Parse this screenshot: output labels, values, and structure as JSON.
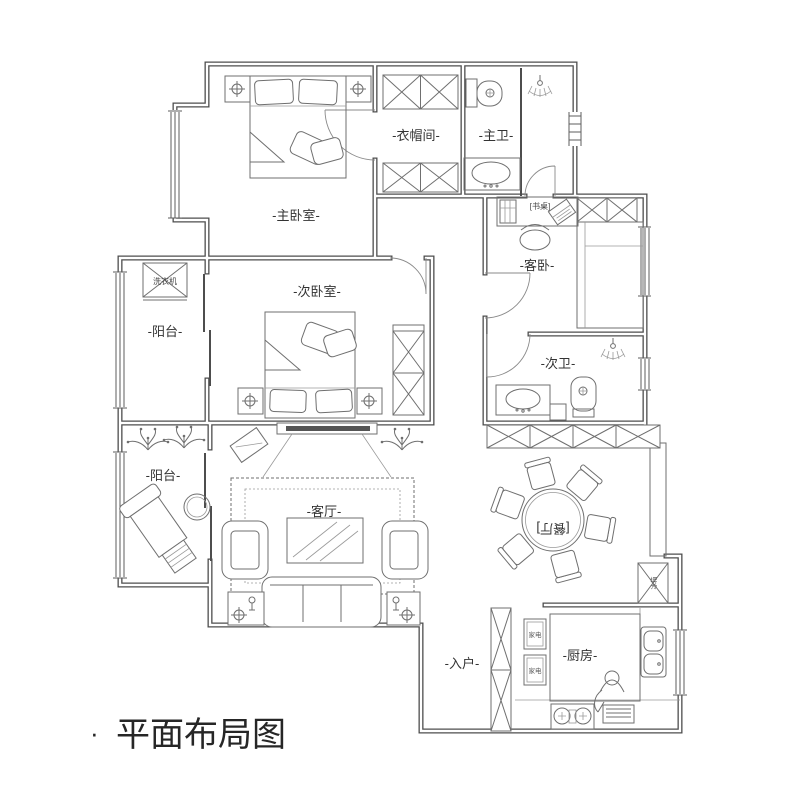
{
  "title": {
    "bullet": "·",
    "text": "平面布局图"
  },
  "rooms": {
    "master_bedroom": "-主卧室-",
    "closet": "-衣帽间-",
    "master_bath": "-主卫-",
    "second_bedroom": "-次卧室-",
    "balcony_upper": "-阳台-",
    "balcony_lower": "-阳台-",
    "guest_bedroom": "-客卧-",
    "second_bath": "-次卫-",
    "living_room": "-客厅-",
    "dining_room": "[餐厅]",
    "entrance": "-入户-",
    "kitchen": "-厨房-"
  },
  "furniture_labels": {
    "desk": "[书桌]",
    "washing_machine": "洗衣机",
    "appliance_1": "家电",
    "appliance_2": "家电",
    "fridge": "冰箱"
  },
  "icons": [
    "ceiling-lamp-icon",
    "shower-icon",
    "plant-icon",
    "person-icon",
    "toilet-icon",
    "sink-icon",
    "stove-icon",
    "vent-icon",
    "laptop-icon"
  ],
  "colors": {
    "wall": "#4d4d4d",
    "furniture": "#6f6f6f",
    "text": "#333333",
    "title": "#262626",
    "background": "#ffffff"
  }
}
